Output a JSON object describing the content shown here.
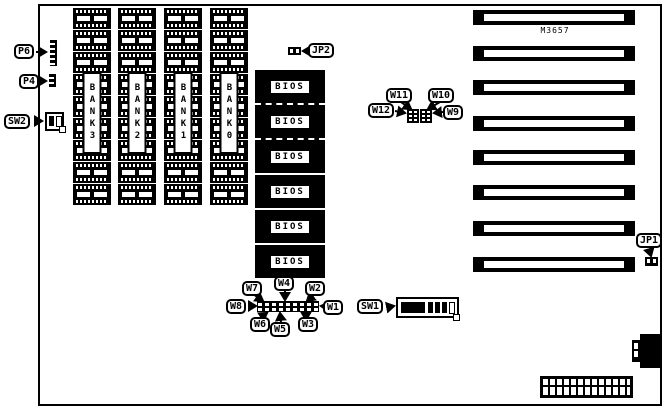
{
  "board": {
    "model": "M3657"
  },
  "colors": {
    "ink": "#000000",
    "paper": "#ffffff"
  },
  "memory": {
    "chips_per_bank": 9,
    "banks": [
      {
        "label": "BANK3"
      },
      {
        "label": "BANK2"
      },
      {
        "label": "BANK1"
      },
      {
        "label": "BANK0"
      }
    ]
  },
  "bios": {
    "chip_label": "BIOS",
    "count": 6
  },
  "expansion_slots": {
    "count": 8
  },
  "connectors": {
    "p6": "P6",
    "p4": "P4",
    "sw2": "SW2",
    "sw1": "SW1",
    "jp1": "JP1",
    "jp2": "JP2"
  },
  "jumpers": {
    "w1": "W1",
    "w2": "W2",
    "w3": "W3",
    "w4": "W4",
    "w5": "W5",
    "w6": "W6",
    "w7": "W7",
    "w8": "W8",
    "w9": "W9",
    "w10": "W10",
    "w11": "W11",
    "w12": "W12"
  }
}
